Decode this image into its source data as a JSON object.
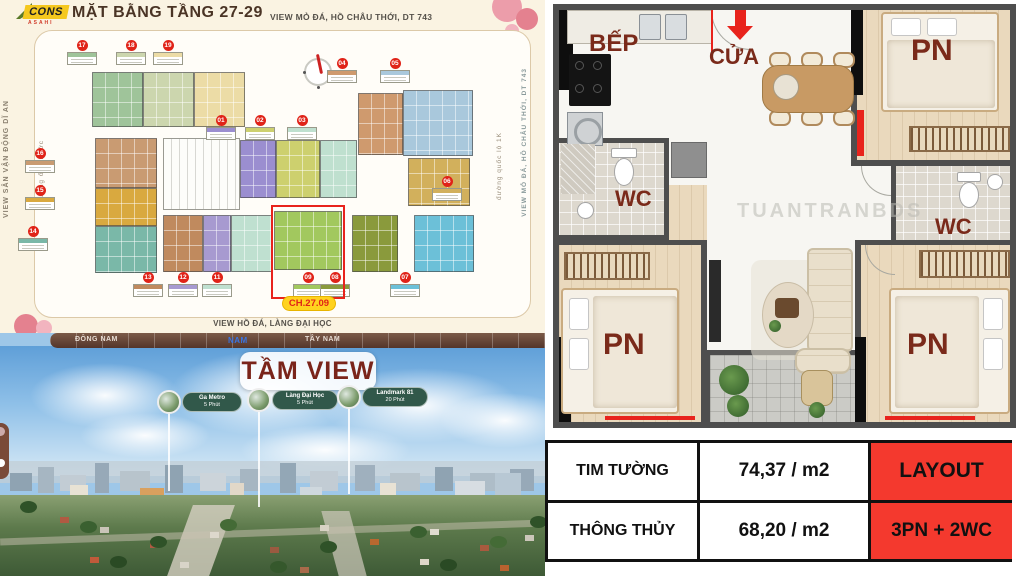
{
  "header": {
    "logo_main": "CONS",
    "logo_sub": "ASAHI",
    "title": "MẶT BẰNG TẦNG 27-29",
    "subtitle": "VIEW MỎ ĐÁ, HỒ CHÂU THỚI, DT 743"
  },
  "site_plan": {
    "left_outer": "VIEW SÂN VẬN ĐỘNG DĨ AN",
    "left_inner": "đường ống nước",
    "right_inner": "đường quốc lộ 1K",
    "right_outer": "VIEW MỎ ĐÁ, HỒ CHÂU THỚI, DT 743",
    "bottom": "VIEW HỒ ĐÁ, LÀNG ĐẠI HỌC",
    "highlight": "CH.27.09",
    "badges": [
      "17",
      "18",
      "19",
      "01",
      "02",
      "03",
      "04",
      "05",
      "06",
      "16",
      "15",
      "14",
      "13",
      "12",
      "11",
      "09",
      "08",
      "07"
    ]
  },
  "panorama": {
    "title": "TẦM VIEW",
    "directions": [
      "ĐÔNG NAM",
      "NAM",
      "TÂY NAM"
    ],
    "active_direction": "NAM",
    "pins": [
      {
        "name": "Ga Metro",
        "time": "5 Phút"
      },
      {
        "name": "Làng Đại Học",
        "time": "5 Phút"
      },
      {
        "name": "Landmark 81",
        "time": "20 Phút"
      }
    ]
  },
  "floorplan": {
    "kitchen": "BẾP",
    "door": "CỬA",
    "bedroom": "PN",
    "wc": "WC",
    "watermark": "TUANTRANBDS"
  },
  "spec_table": {
    "rows": [
      {
        "label": "TIM TƯỜNG",
        "value": "74,37 / m2",
        "tag": "LAYOUT"
      },
      {
        "label": "THÔNG THỦY",
        "value": "68,20 / m2",
        "tag": "3PN + 2WC"
      }
    ]
  },
  "colors": {
    "accent_red": "#e8231c",
    "highlight_yellow": "#ffd21f",
    "table_red": "#f4392e",
    "pin_green": "#31584a",
    "direction_bar_brown": "#63402f",
    "active_direction_blue": "#3a74e0",
    "label_maroon": "#7a2a1a"
  }
}
